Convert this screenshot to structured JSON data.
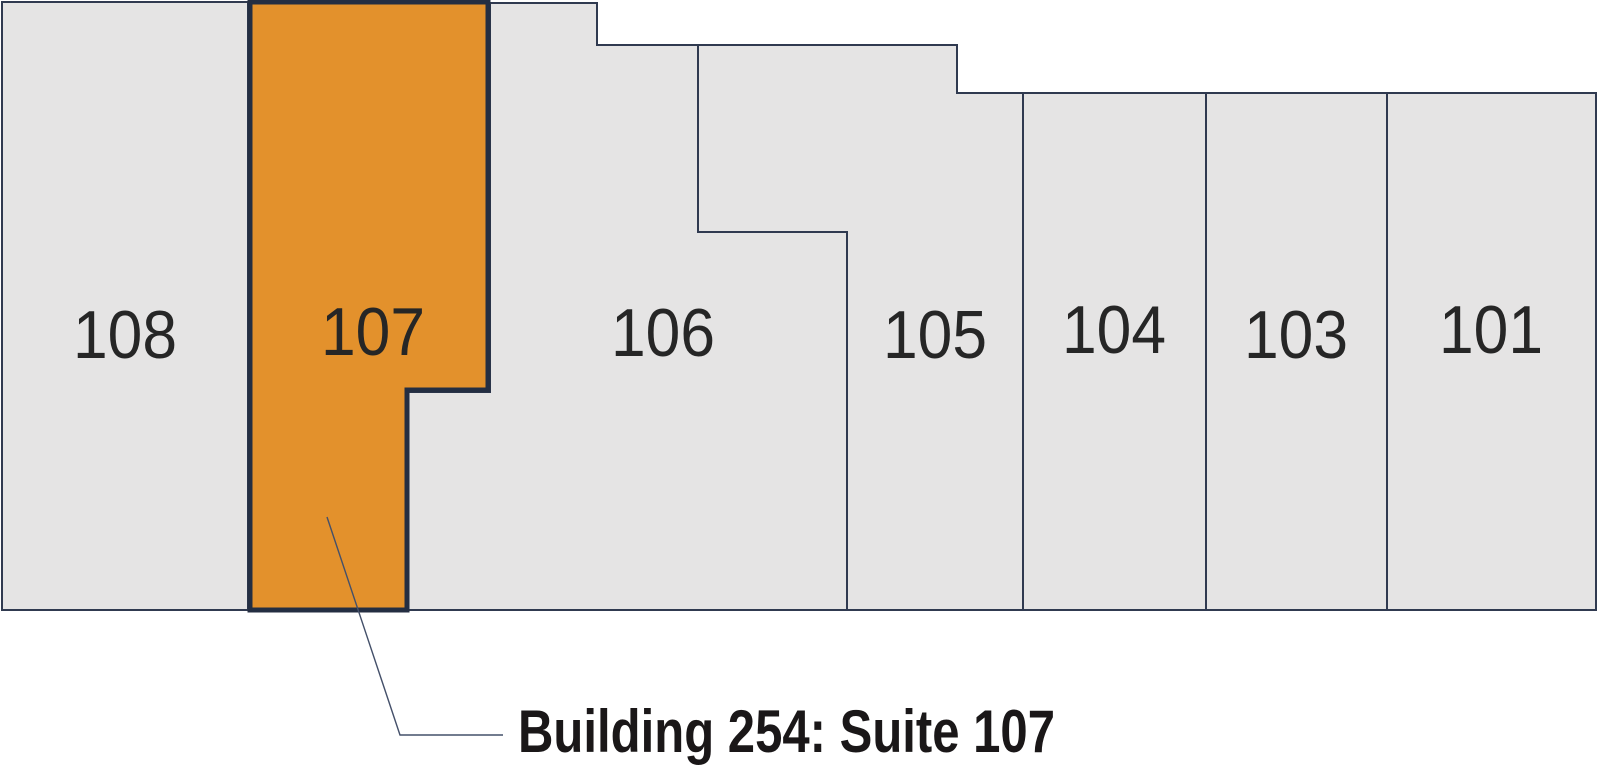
{
  "map": {
    "building": "254",
    "highlighted_suite": "107",
    "suites": [
      {
        "id": "108",
        "label": "108",
        "highlighted": false
      },
      {
        "id": "107",
        "label": "107",
        "highlighted": true
      },
      {
        "id": "106",
        "label": "106",
        "highlighted": false
      },
      {
        "id": "105",
        "label": "105",
        "highlighted": false
      },
      {
        "id": "104",
        "label": "104",
        "highlighted": false
      },
      {
        "id": "103",
        "label": "103",
        "highlighted": false
      },
      {
        "id": "101",
        "label": "101",
        "highlighted": false
      }
    ],
    "callout": {
      "text": "Building 254: Suite 107"
    },
    "colors": {
      "highlight_fill": "#E3912C",
      "suite_fill": "#E5E4E4",
      "outline_thick": "#242E42",
      "outline_thin": "#303A50",
      "label_text": "#262626",
      "callout_text": "#1A1718",
      "leader_line": "#44506A",
      "background": "#FFFFFF"
    }
  }
}
